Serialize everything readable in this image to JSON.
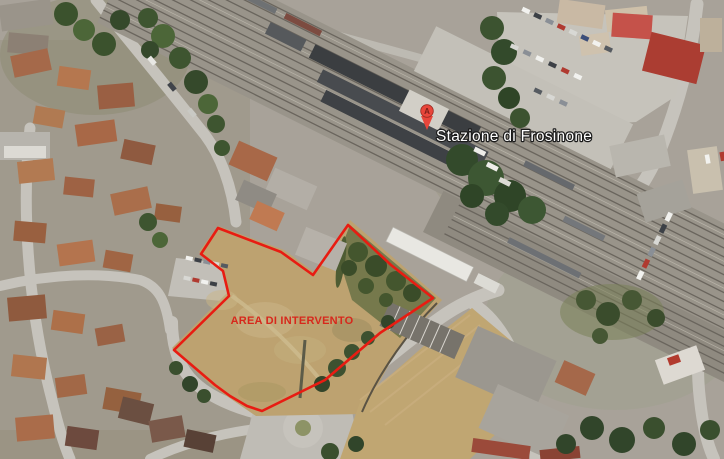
{
  "map": {
    "station_label": "Stazione di Frosinone",
    "area_label": "AREA DI INTERVENTO",
    "marker_letter": "A",
    "colors": {
      "outline": "#e81c12",
      "area_label": "#d7281c",
      "marker": "#e8463b"
    },
    "area_outline_points": "218,228 281,252 313,275 348,225 391,265 433,298 380,333 325,380 262,411 247,406 230,396 215,385 174,350 229,296 223,271 201,254"
  }
}
